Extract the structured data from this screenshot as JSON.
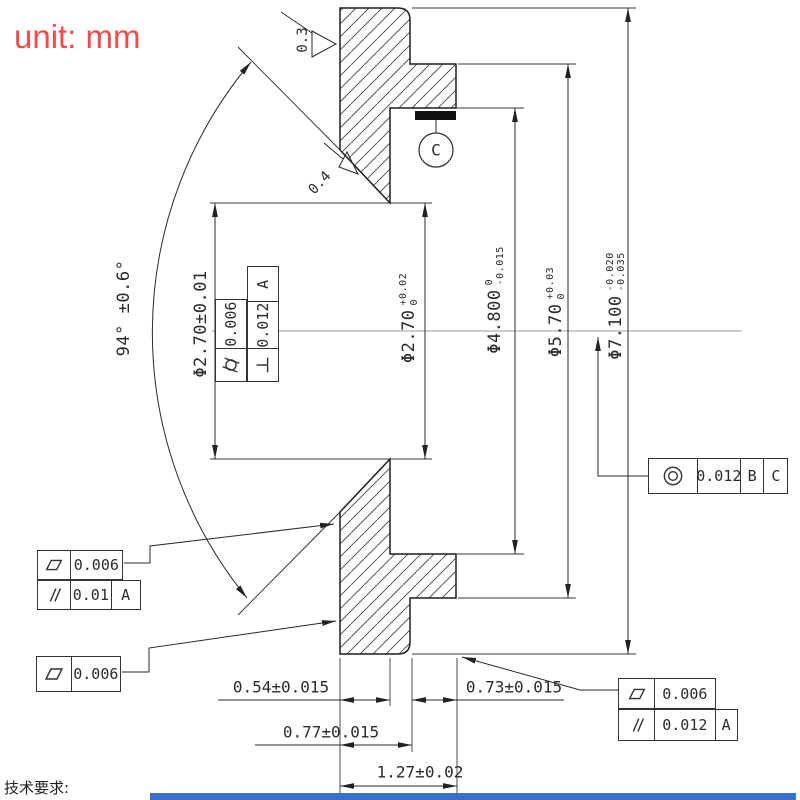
{
  "unit_label": "unit: mm",
  "tech_requirements": "技术要求:",
  "surface": {
    "top": "0.3",
    "seat": "0.4"
  },
  "angle": {
    "label": "94° ±0.6°"
  },
  "datum_target": {
    "letter": "C"
  },
  "dia_dims": {
    "d1": {
      "text": "Φ2.70±0.01"
    },
    "d2": {
      "main": "Φ2.70",
      "upper": "+0.02",
      "lower": "0"
    },
    "d3": {
      "main": "Φ4.800",
      "upper": "0",
      "lower": "-0.015"
    },
    "d4": {
      "main": "Φ5.70",
      "upper": "+0.03",
      "lower": "0"
    },
    "d5": {
      "main": "Φ7.100",
      "upper": "-0.020",
      "lower": "-0.035"
    }
  },
  "len_dims": {
    "a": "0.54±0.015",
    "b": "0.73±0.015",
    "c": "0.77±0.015",
    "d": "1.27±0.02"
  },
  "fcf": {
    "cylindricity": {
      "value": "0.006"
    },
    "perpendicularity": {
      "value": "0.012",
      "datum": "A"
    },
    "left_flatness": {
      "value": "0.006"
    },
    "left_parallelism": {
      "value": "0.01",
      "datum": "A"
    },
    "bottom_left_flatness": {
      "value": "0.006"
    },
    "concentricity": {
      "value": "0.012",
      "datum_b": "B",
      "datum_c": "C"
    },
    "bottom_right_flatness": {
      "value": "0.006"
    },
    "bottom_right_parallelism": {
      "value": "0.012",
      "datum": "A"
    }
  },
  "colors": {
    "red": "#f24b4b",
    "line": "#1f1f1f",
    "blue_bar": "#3a70c8"
  }
}
